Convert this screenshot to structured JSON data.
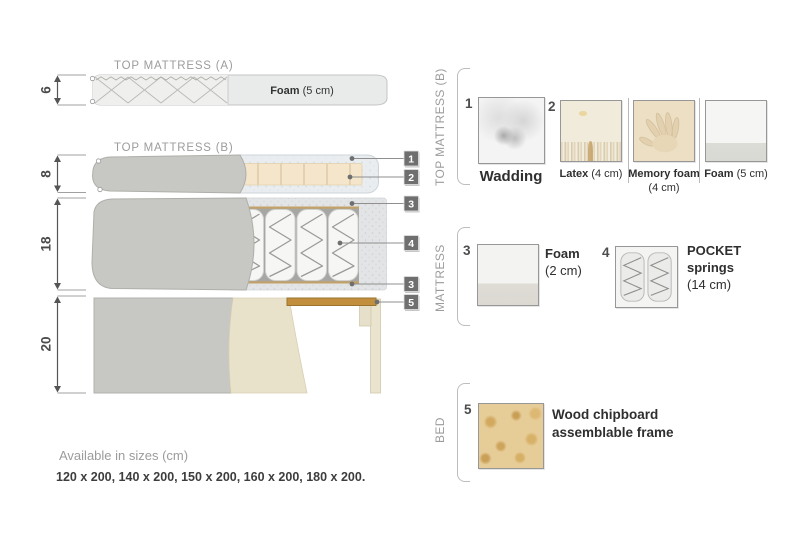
{
  "colors": {
    "tag_bg": "#6f6f6f",
    "heading_gray": "#9c9c9c",
    "text_dark": "#2f2f2f",
    "wood": "#c28f3e",
    "fabric_gray": "#c7c7c3",
    "latex_cream": "#f4e5cb"
  },
  "diagram": {
    "tma": {
      "title": "TOP MATTRESS (A)",
      "dim": "6",
      "foam_bold": "Foam",
      "foam_rest": " (5 cm)"
    },
    "tmb": {
      "title": "TOP MATTRESS (B)",
      "dim": "8"
    },
    "mattress": {
      "dim": "18"
    },
    "bed": {
      "dim": "20"
    },
    "tags": [
      {
        "n": "1"
      },
      {
        "n": "2"
      },
      {
        "n": "3"
      },
      {
        "n": "4"
      },
      {
        "n": "3"
      },
      {
        "n": "5"
      }
    ]
  },
  "legend": {
    "top_mattress_b": {
      "heading": "TOP MATTRESS (B)",
      "items": [
        {
          "num": "1",
          "bold": "Wadding",
          "rest": ""
        },
        {
          "num": "2",
          "bold": "Latex",
          "rest": " (4 cm)"
        },
        {
          "num": "",
          "bold": "Memory foam",
          "rest": " (4 cm)"
        },
        {
          "num": "",
          "bold": "Foam",
          "rest": " (5 cm)"
        }
      ]
    },
    "mattress": {
      "heading": "MATTRESS",
      "items": [
        {
          "num": "3",
          "bold": "Foam",
          "rest": "(2 cm)"
        },
        {
          "num": "4",
          "bold": "POCKET springs",
          "rest": "(14 cm)"
        }
      ]
    },
    "bed": {
      "heading": "BED",
      "items": [
        {
          "num": "5",
          "bold": "Wood chipboard assemblable frame",
          "rest": ""
        }
      ]
    }
  },
  "footer": {
    "title": "Available in sizes (cm)",
    "sizes": "120 x 200, 140 x 200, 150 x 200, 160 x 200, 180 x 200."
  }
}
